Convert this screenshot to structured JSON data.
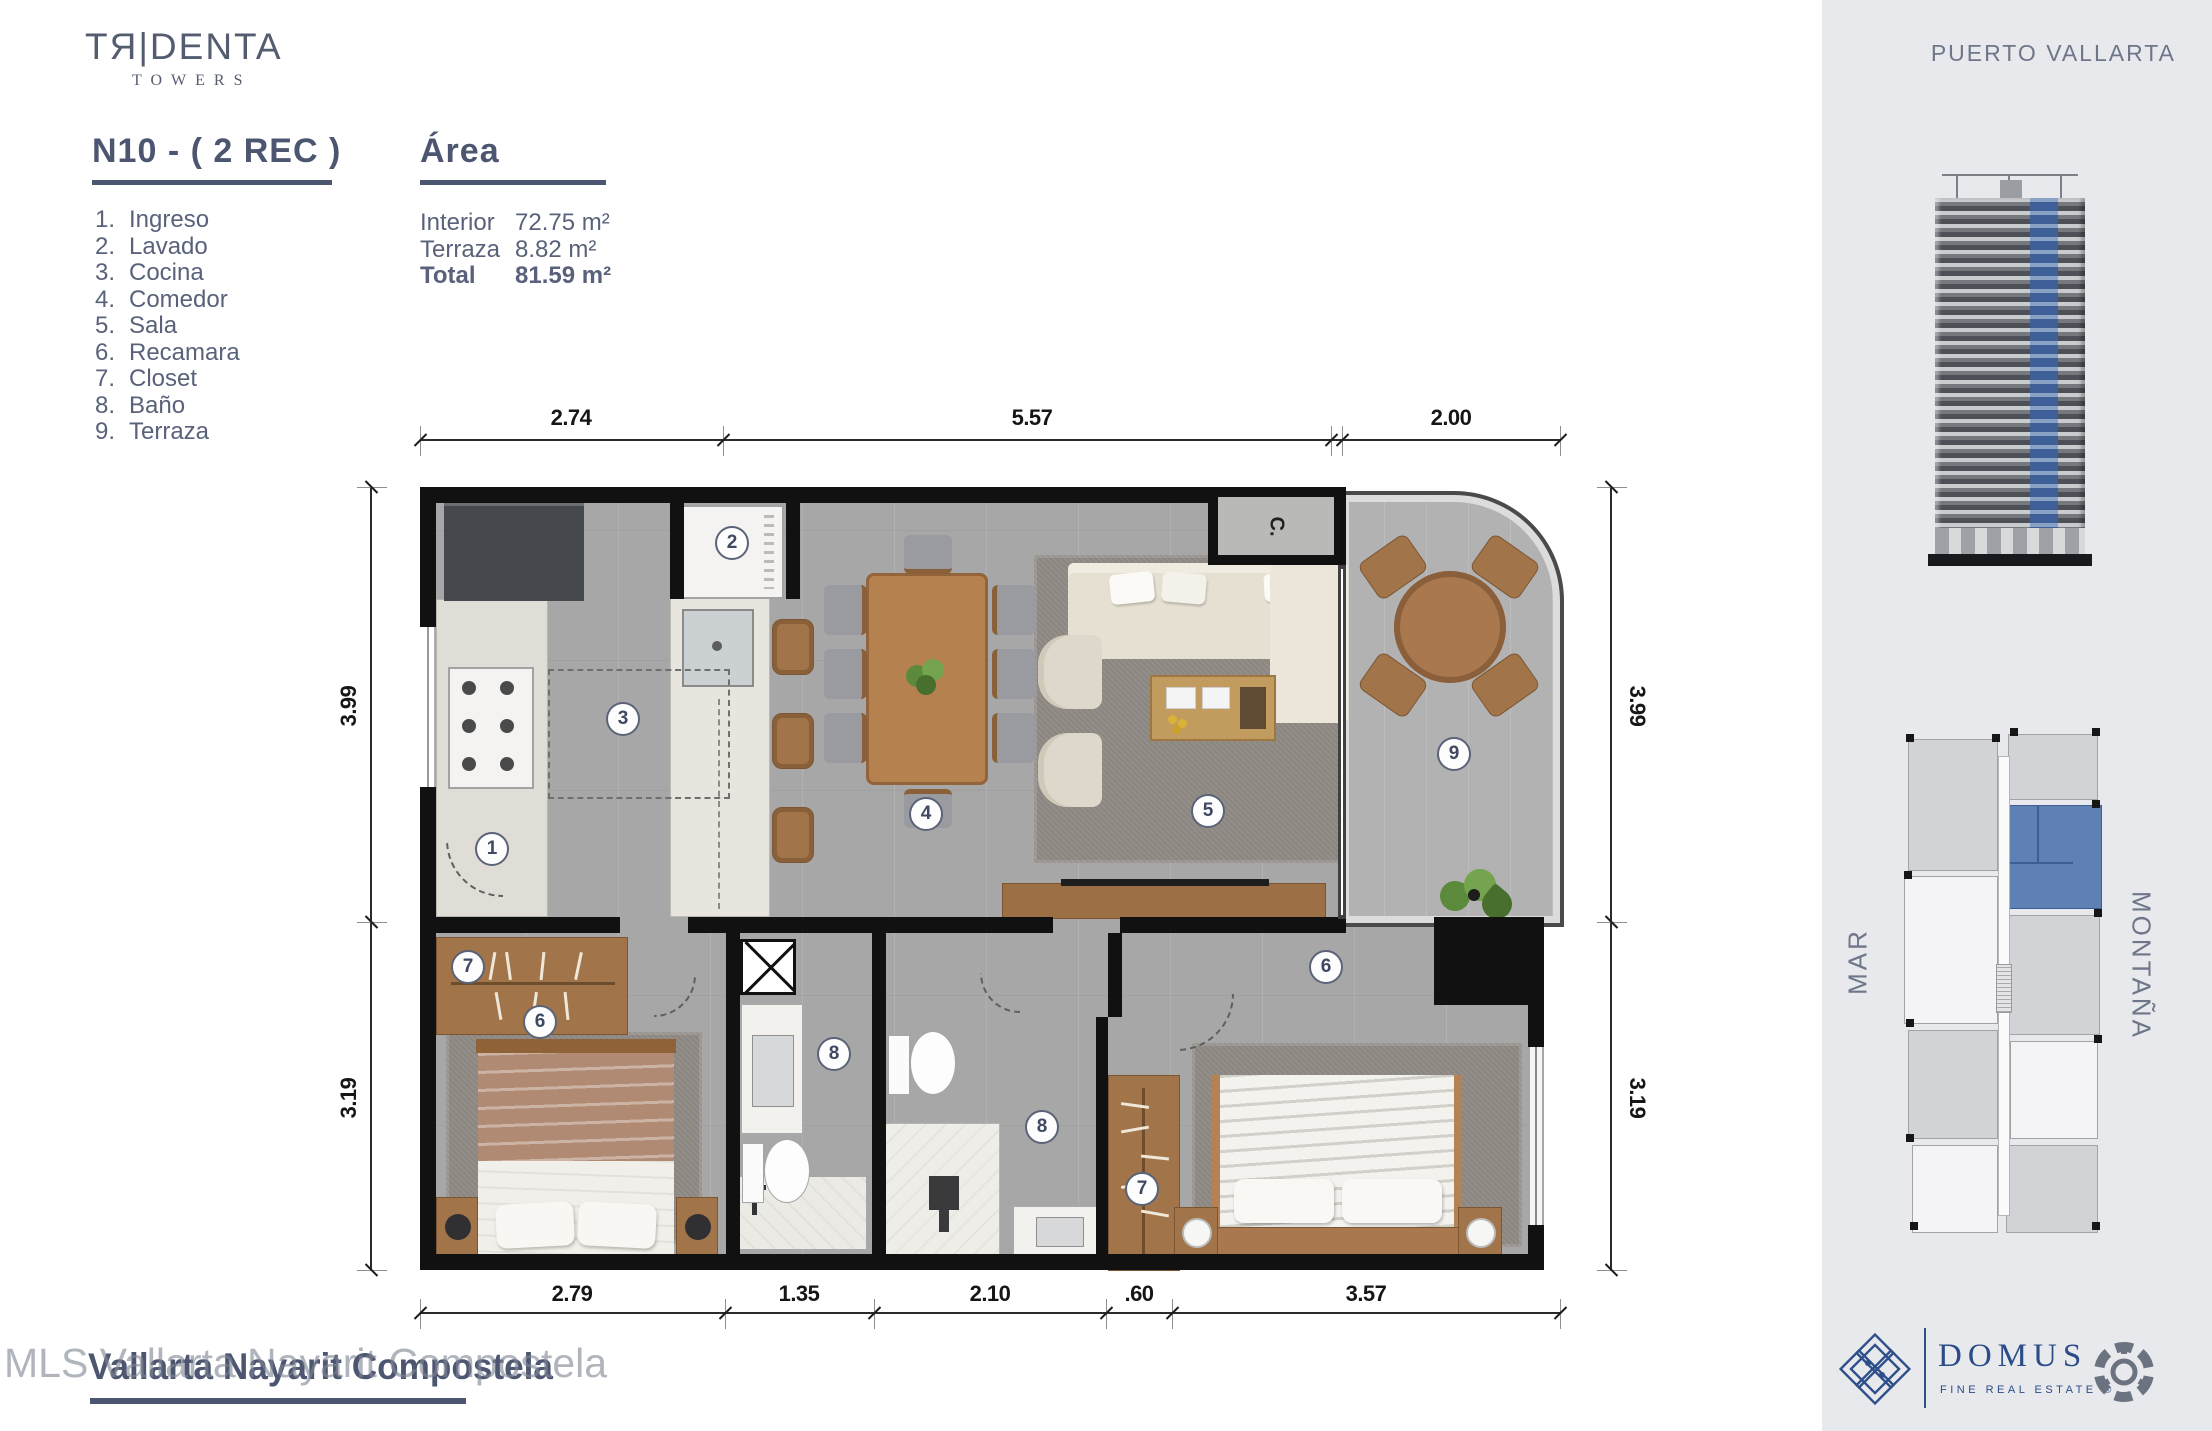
{
  "brand": {
    "logo": "TЯ|DENTA",
    "sub": "TOWERS"
  },
  "unit": {
    "title": "N10 - ( 2 REC )"
  },
  "legend": {
    "items": [
      {
        "n": "1.",
        "t": "Ingreso"
      },
      {
        "n": "2.",
        "t": "Lavado"
      },
      {
        "n": "3.",
        "t": "Cocina"
      },
      {
        "n": "4.",
        "t": "Comedor"
      },
      {
        "n": "5.",
        "t": "Sala"
      },
      {
        "n": "6.",
        "t": "Recamara"
      },
      {
        "n": "7.",
        "t": "Closet"
      },
      {
        "n": "8.",
        "t": "Baño"
      },
      {
        "n": "9.",
        "t": "Terraza"
      }
    ]
  },
  "area": {
    "title": "Área",
    "rows": [
      {
        "label": "Interior",
        "value": "72.75 m²"
      },
      {
        "label": "Terraza",
        "value": "8.82 m²"
      },
      {
        "label": "Total",
        "value": "81.59 m²"
      }
    ]
  },
  "plan": {
    "closet_label": "C.",
    "dims": {
      "top": [
        "2.74",
        "5.57",
        "2.00"
      ],
      "bottom": [
        "2.79",
        "1.35",
        "2.10",
        ".60",
        "3.57"
      ],
      "left": [
        "3.99",
        "3.19"
      ],
      "right": [
        "3.99",
        "3.19"
      ]
    },
    "markers": {
      "ingreso": "1",
      "lavado": "2",
      "cocina": "3",
      "comedor": "4",
      "sala": "5",
      "recamara_a": "6",
      "closet_a": "7",
      "bano_a": "8",
      "bano_b": "8",
      "closet_b": "7",
      "recamara_b": "6",
      "terraza": "9"
    }
  },
  "sidebar": {
    "location": "PUERTO VALLARTA",
    "mar": "MAR",
    "montana": "MONTAÑA",
    "domus": {
      "name": "DOMUS",
      "tagline": "FINE REAL ESTATE  ®"
    }
  },
  "footer": {
    "title": "Vallarta Nayarit Compostela",
    "watermark": "MLS Vallarta Nayarit Compostela"
  },
  "colors": {
    "accent_blue": "#3e5f97",
    "heading": "#4d5670",
    "sidebar_bg": "#e8e9ec"
  }
}
